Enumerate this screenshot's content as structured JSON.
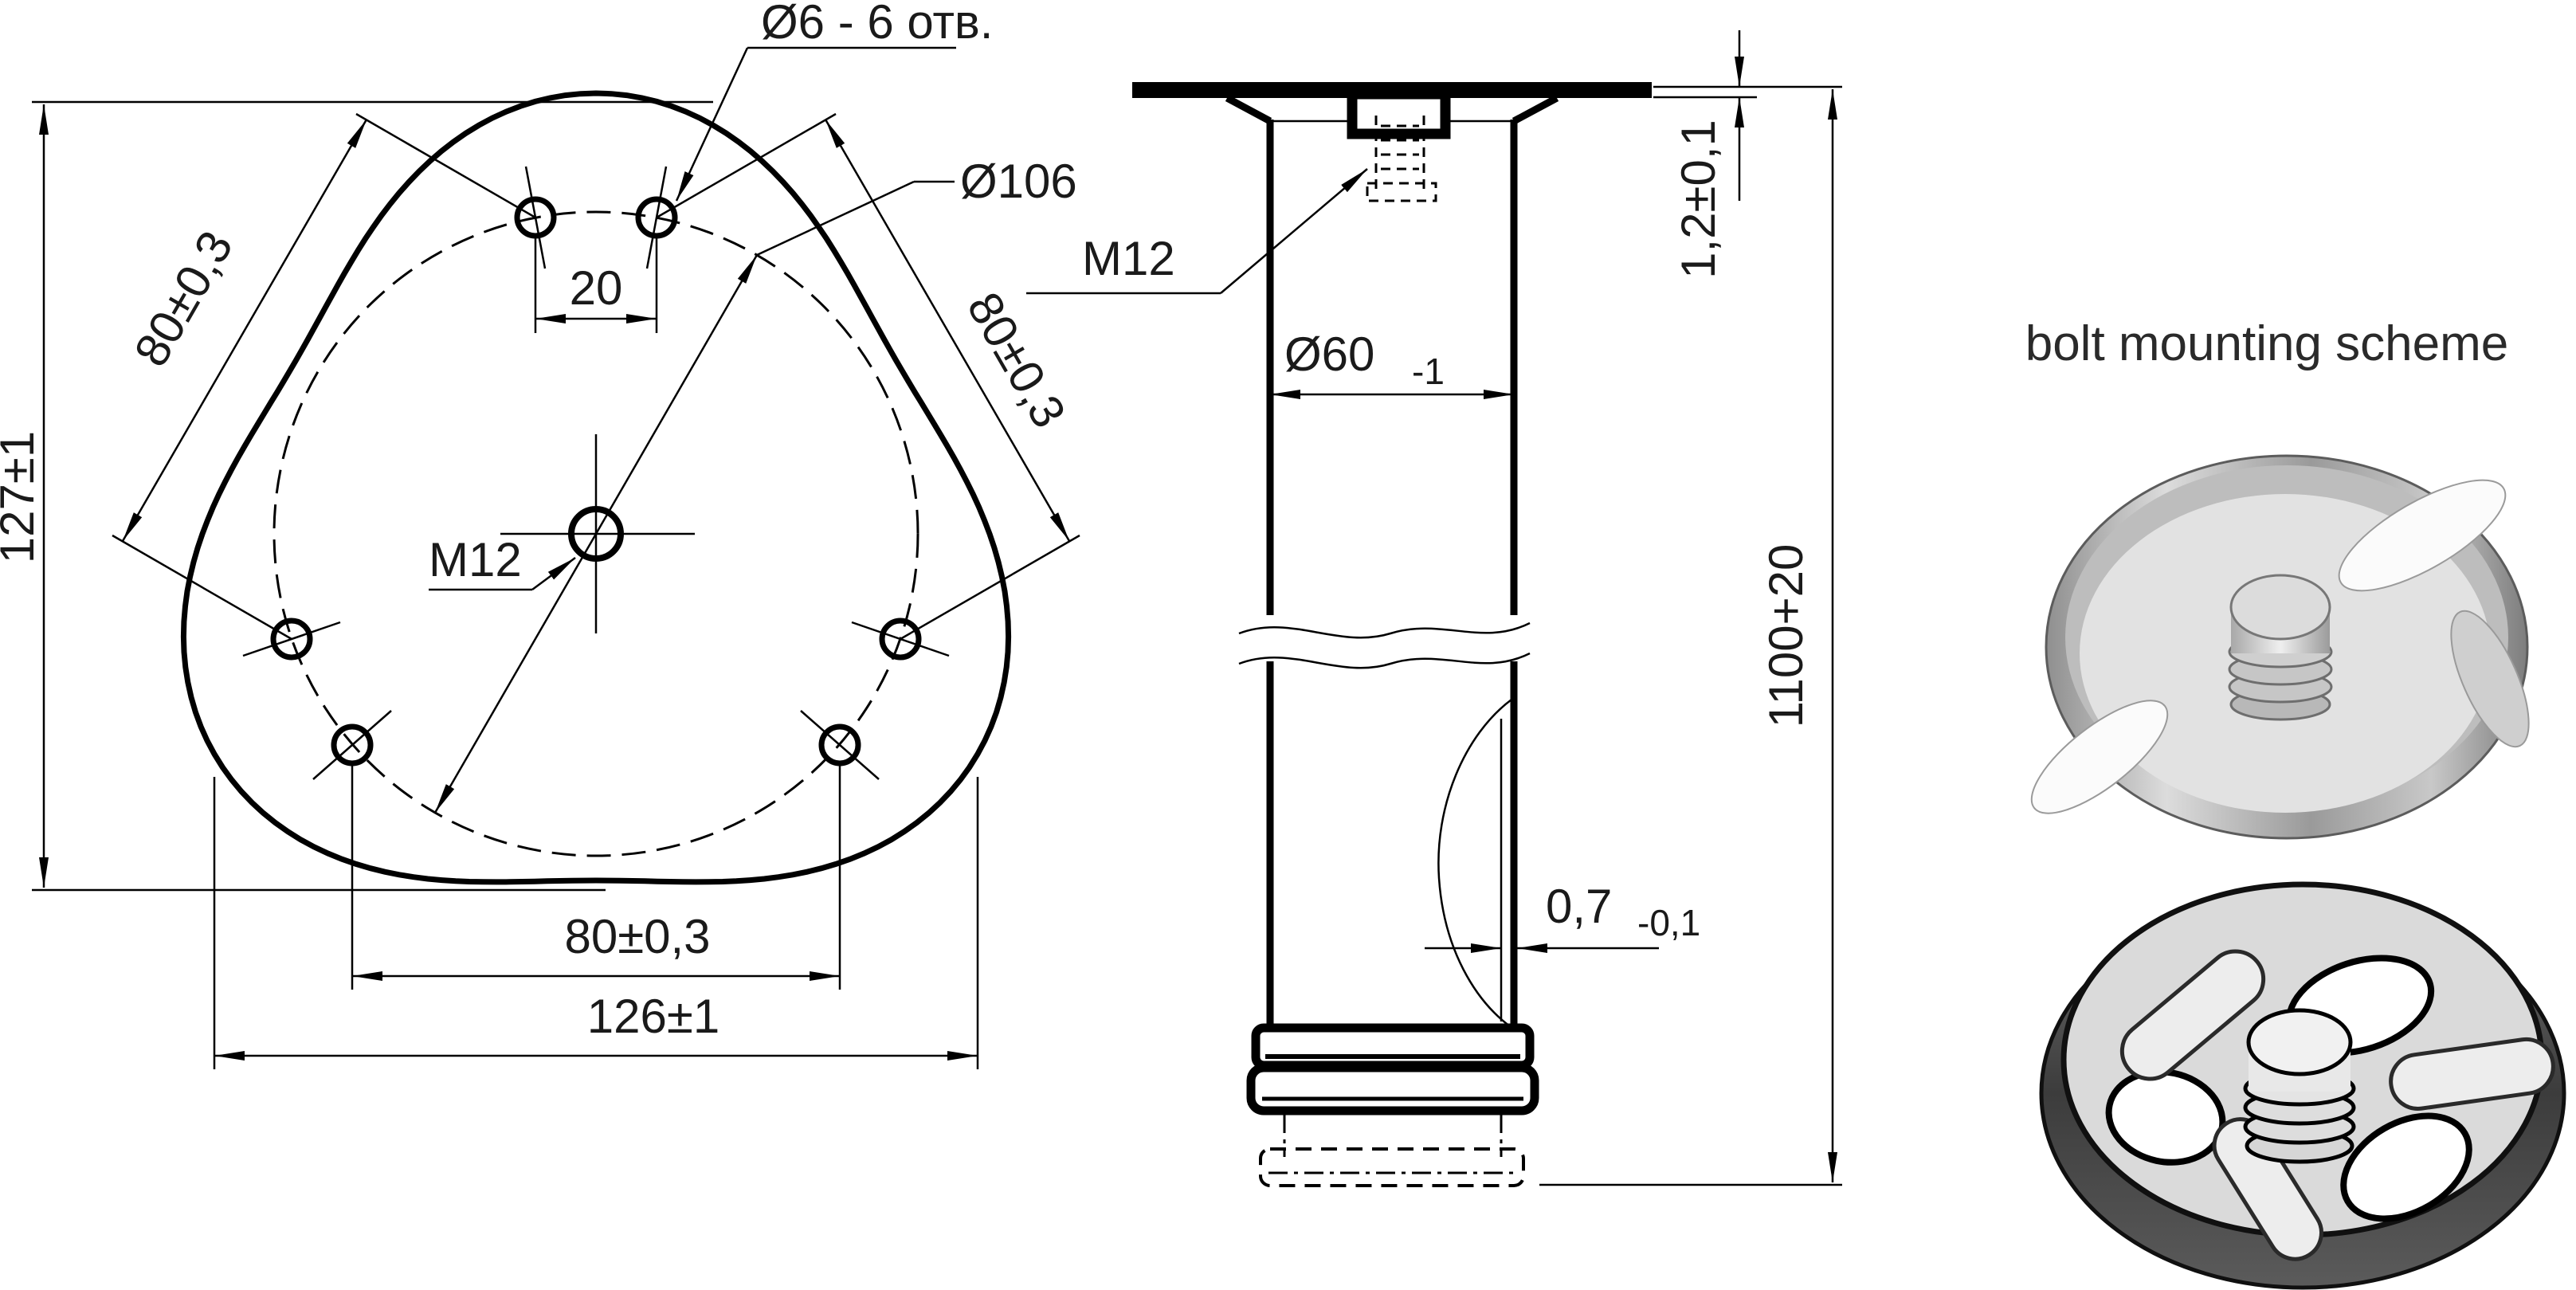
{
  "colors": {
    "line": "#000000",
    "background": "#ffffff",
    "metal_light": "#e0e0e0",
    "metal_dark": "#3a3a3a"
  },
  "top_view": {
    "holes_callout": "Ø6 - 6 отв.",
    "bolt_circle_dia": "Ø106",
    "center_thread": "M12",
    "hole_pair_spacing": "20",
    "overall_height": "127±1",
    "overall_width": "126±1",
    "hole_spacing_left": "80±0,3",
    "hole_spacing_right": "80±0,3",
    "hole_spacing_bottom": "80±0,3",
    "hole_count": 6,
    "hole_diameter_mm": 6,
    "bolt_circle_mm": 106
  },
  "side_view": {
    "insert_thread": "M12",
    "tube_diameter": "Ø60",
    "tube_diameter_tol": "-1",
    "plate_thickness": "1,2±0,1",
    "leg_length": "1100+20",
    "wall_thickness": "0,7",
    "wall_thickness_tol": "-0,1"
  },
  "right_panel": {
    "title": "bolt mounting scheme"
  }
}
